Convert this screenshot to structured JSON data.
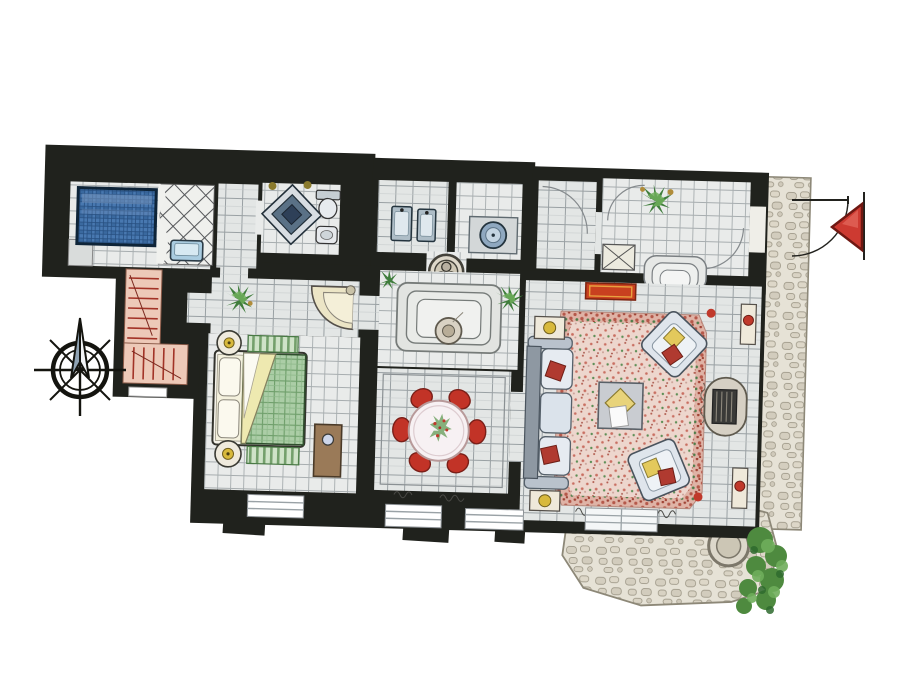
{
  "document": {
    "kind": "hand-drawn watercolor architectural floor plan",
    "background": "#ffffff",
    "orientation_marker": "compass-rose-north-arrow",
    "entrance_marker": "door-swing-arc-with-red-pennant"
  },
  "palette": {
    "wall_black": "#20221d",
    "tile_floor": "#e9ebea",
    "pool_blue": "#4878b0",
    "tub_blue": "#aacce0",
    "stone_gray": "#e6e2d6",
    "rug_pink": "#edd6cd",
    "rug_border_pink": "#dfb3a6",
    "accent_red": "#c23327",
    "runner_red": "#c8401f",
    "plant_green": "#3f7d3c",
    "duvet_green": "#abcda6",
    "stair_pink": "#edc9b8",
    "wood_brown": "#9a7a58",
    "lamp_yellow": "#d8b93c",
    "cushion_blue": "#b9c8d8"
  },
  "rooms": [
    {
      "name": "spa-pool-room",
      "features": [
        "blue-mosaic-plunge-pool",
        "corner-step"
      ]
    },
    {
      "name": "shower-room",
      "features": [
        "lattice-screen-floor",
        "small-blue-bathtub"
      ]
    },
    {
      "name": "wc-room",
      "features": [
        "diamond-floor-medallion",
        "toilet",
        "bidet",
        "wall-lights"
      ]
    },
    {
      "name": "bathroom",
      "features": [
        "twin-sinks",
        "round-basin-on-counter"
      ]
    },
    {
      "name": "entry-hall",
      "features": [
        "potted-plant",
        "door-swing-arcs",
        "closet-with-cross",
        "steps-to-living-room"
      ]
    },
    {
      "name": "stair-hall",
      "features": [
        "l-shaped-staircase-with-red-treads",
        "slit-window"
      ]
    },
    {
      "name": "bedroom-hallway",
      "features": [
        "potted-plant",
        "corner-fan-basin"
      ]
    },
    {
      "name": "bedroom",
      "features": [
        "double-bed-green-check-duvet",
        "folded-back-cover",
        "two-round-nightstands-with-lamps",
        "two-green-striped-rugs",
        "wood-wardrobe"
      ]
    },
    {
      "name": "courtyard-steps",
      "features": [
        "nested-steps",
        "round-fountain-basin",
        "three-circle-floor-medallion",
        "plants"
      ]
    },
    {
      "name": "dining-room",
      "features": [
        "round-white-table",
        "six-red-chairs",
        "flower-centerpiece"
      ]
    },
    {
      "name": "living-room",
      "features": [
        "large-pink-floral-rug",
        "three-seat-sofa",
        "two-angled-armchairs",
        "coffee-table-with-yellow-diamond",
        "fireplace-with-grate",
        "side-tables-with-lamps",
        "red-orange-runner-rug",
        "wall-consoles-with-red-lamps"
      ]
    },
    {
      "name": "terrace",
      "features": [
        "cobblestone-paving-strip",
        "lower-stone-patio",
        "round-stone-well",
        "ivy-shrubs"
      ]
    }
  ],
  "furniture_counts": {
    "dining_chairs": 6,
    "sofas": 1,
    "armchairs": 2,
    "nightstands": 2,
    "sinks": 2,
    "plants": 5
  },
  "annotations": {
    "compass": "eight-spoke-compass-rose-with-tall-north-needle",
    "entrance": "quarter-arc-door-swing-with-red-triangular-pennant",
    "windows": "white-gaps-in-black-poche-walls-along-bottom"
  }
}
